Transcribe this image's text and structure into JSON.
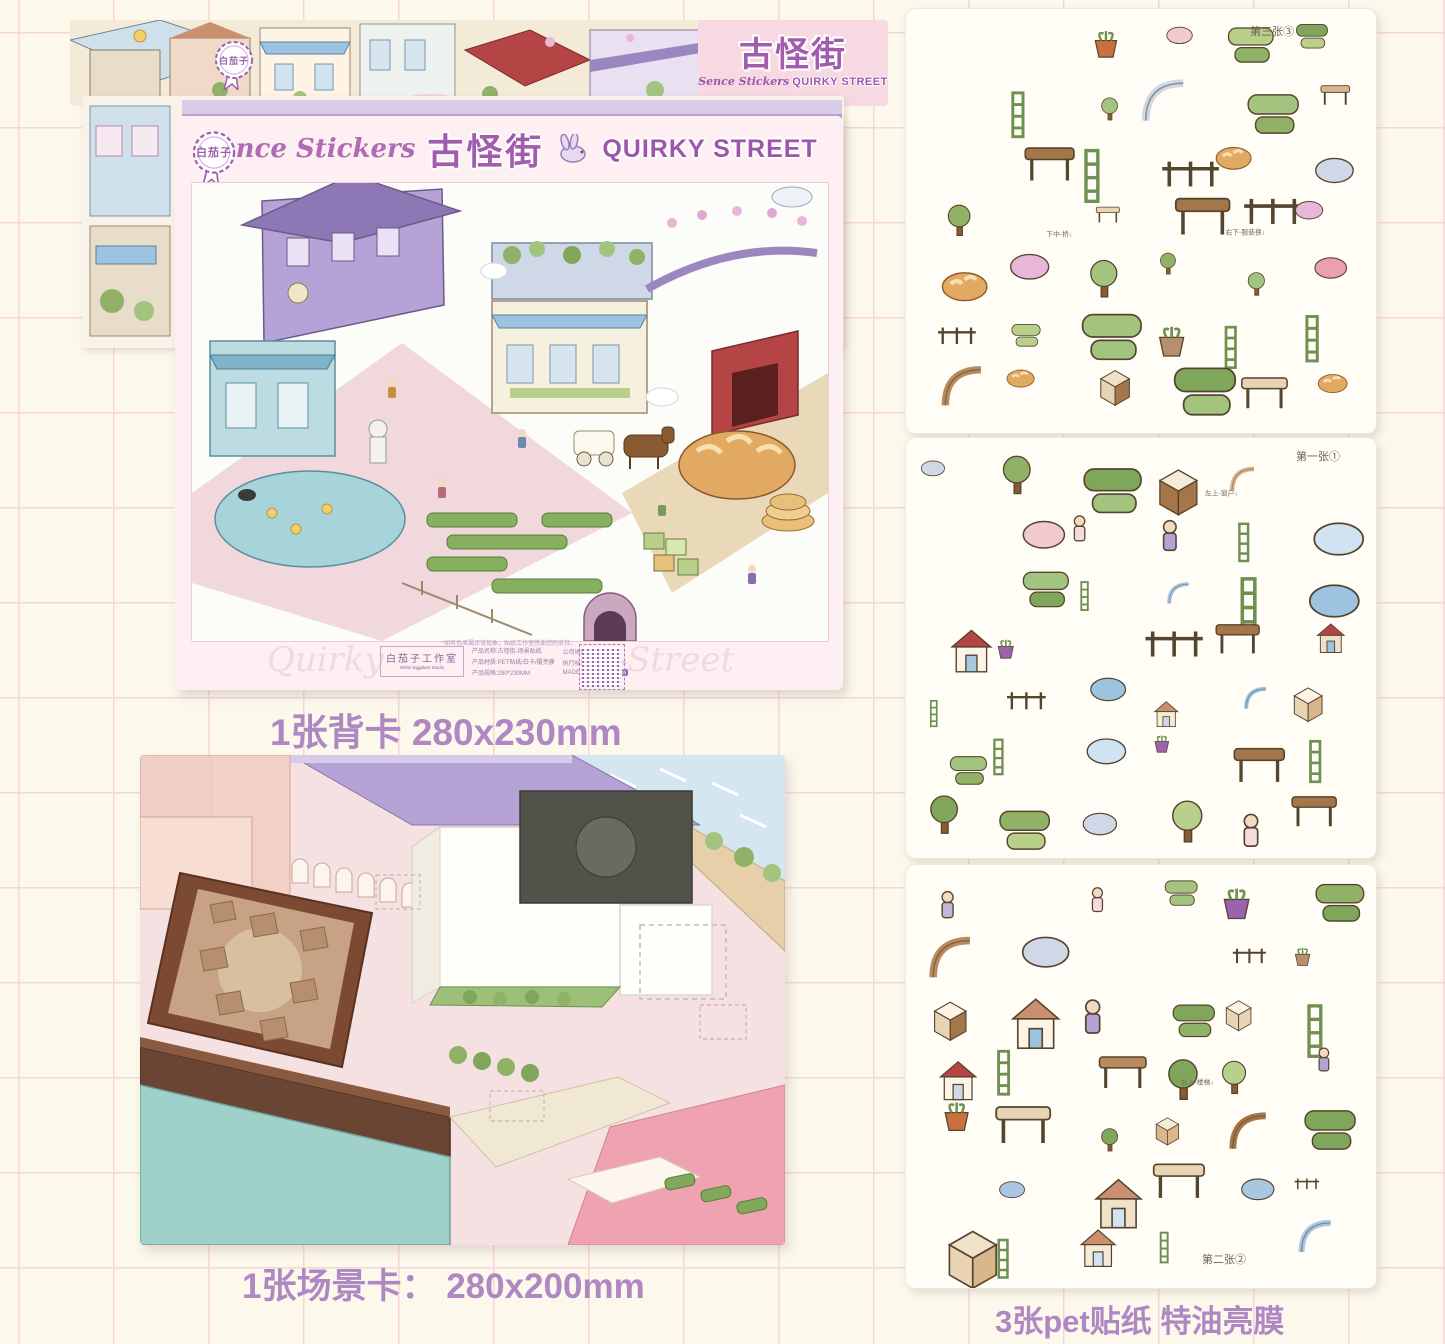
{
  "brand": {
    "badge_text": "白茄子",
    "logo_cn": "古怪街",
    "logo_script": "Sence Stickers",
    "logo_en": "QUIRKY STREET",
    "accent_purple": "#a25cae",
    "caption_purple": "#af87c3",
    "banner_pink": "#f7d9e2"
  },
  "backing_card": {
    "badge_text": "白茄子",
    "header_script": "Sence Stickers",
    "header_cn": "古怪街",
    "header_en": "QUIRKY STREET",
    "footer": {
      "script_left": "Quirky",
      "script_right": "Street",
      "studio_cn": "白茄子工作室",
      "studio_en": "White Eggplant Studio",
      "note": "*如有色差属正常现象，贴纸工作室感谢您的支持。",
      "info_left_1": "产品名称:古怪街-场景贴纸",
      "info_left_2": "产品材质:PET贴纸/白卡/覆亮膜",
      "info_left_3": "产品规格:280*230MM",
      "info_right_1": "公司地址:中国浙江",
      "info_right_2": "执行标准:GB2012-2020",
      "info_right_3": "MADE IN CHINA",
      "grade_badge": "合格品"
    }
  },
  "captions": {
    "backing": "1张背卡 280x230mm",
    "scene": "1张场景卡： 280x200mm",
    "stickers": "3张pet贴纸  特油亮膜"
  },
  "sheets": [
    {
      "label": "第三张③",
      "tags": [
        "下中-桥↓",
        "右下-服装换↓"
      ]
    },
    {
      "label": "第一张①",
      "tags": [
        "左上-窗户↓"
      ]
    },
    {
      "label": "第二张②",
      "tags": [
        "右上-楼梯↓"
      ]
    }
  ]
}
